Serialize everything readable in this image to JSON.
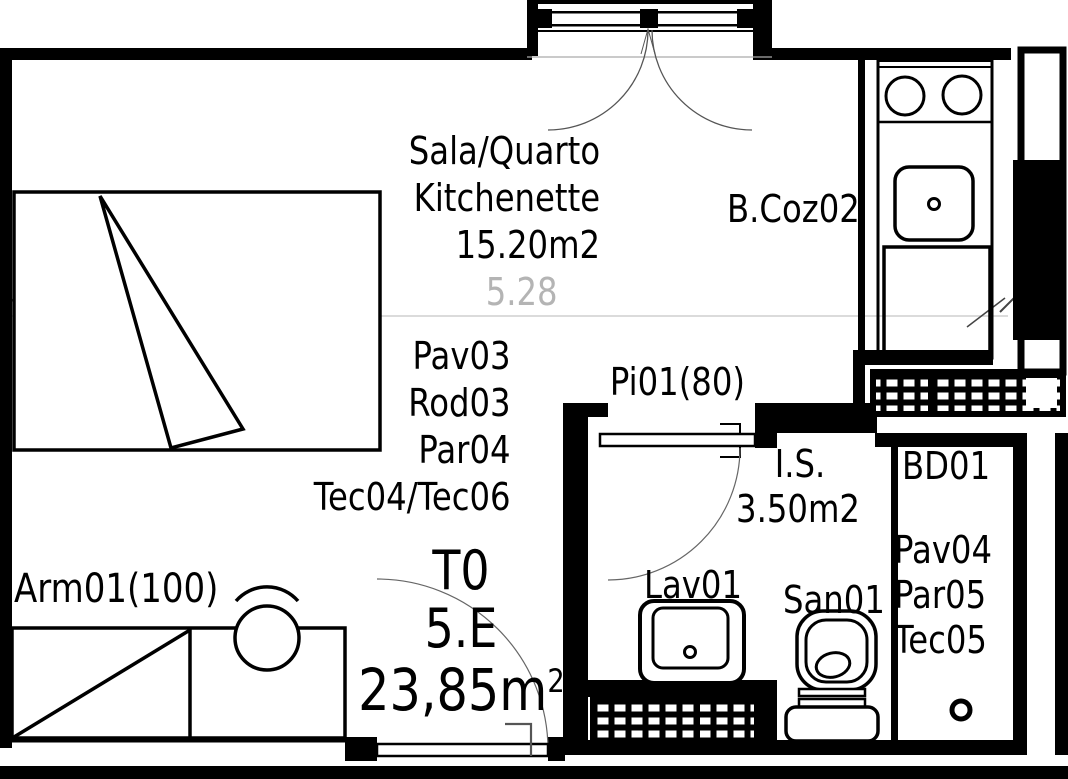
{
  "colors": {
    "ink": "#000000",
    "faint_line": "#c8c8c8",
    "dim_text": "#b4b4b4",
    "background": "#ffffff"
  },
  "main_room": {
    "name_line1": "Sala/Quarto",
    "name_line2": "Kitchenette",
    "area": "15.20m2",
    "width_dim": "5.28",
    "finishes": [
      "Pav03",
      "Rod03",
      "Par04",
      "Tec04/Tec06"
    ]
  },
  "kitchen": {
    "label": "B.Coz02"
  },
  "interior_door": {
    "label": "Pi01(80)"
  },
  "bathroom": {
    "name": "I.S.",
    "area": "3.50m2",
    "washbasin_label": "Lav01",
    "toilet_label": "San01"
  },
  "bd_room": {
    "label": "BD01",
    "finishes": [
      "Pav04",
      "Par05",
      "Tec05"
    ]
  },
  "wardrobe": {
    "label": "Arm01(100)"
  },
  "unit": {
    "type": "T0",
    "number": "5.E",
    "area_value": "23,85m",
    "area_exponent": "2"
  }
}
